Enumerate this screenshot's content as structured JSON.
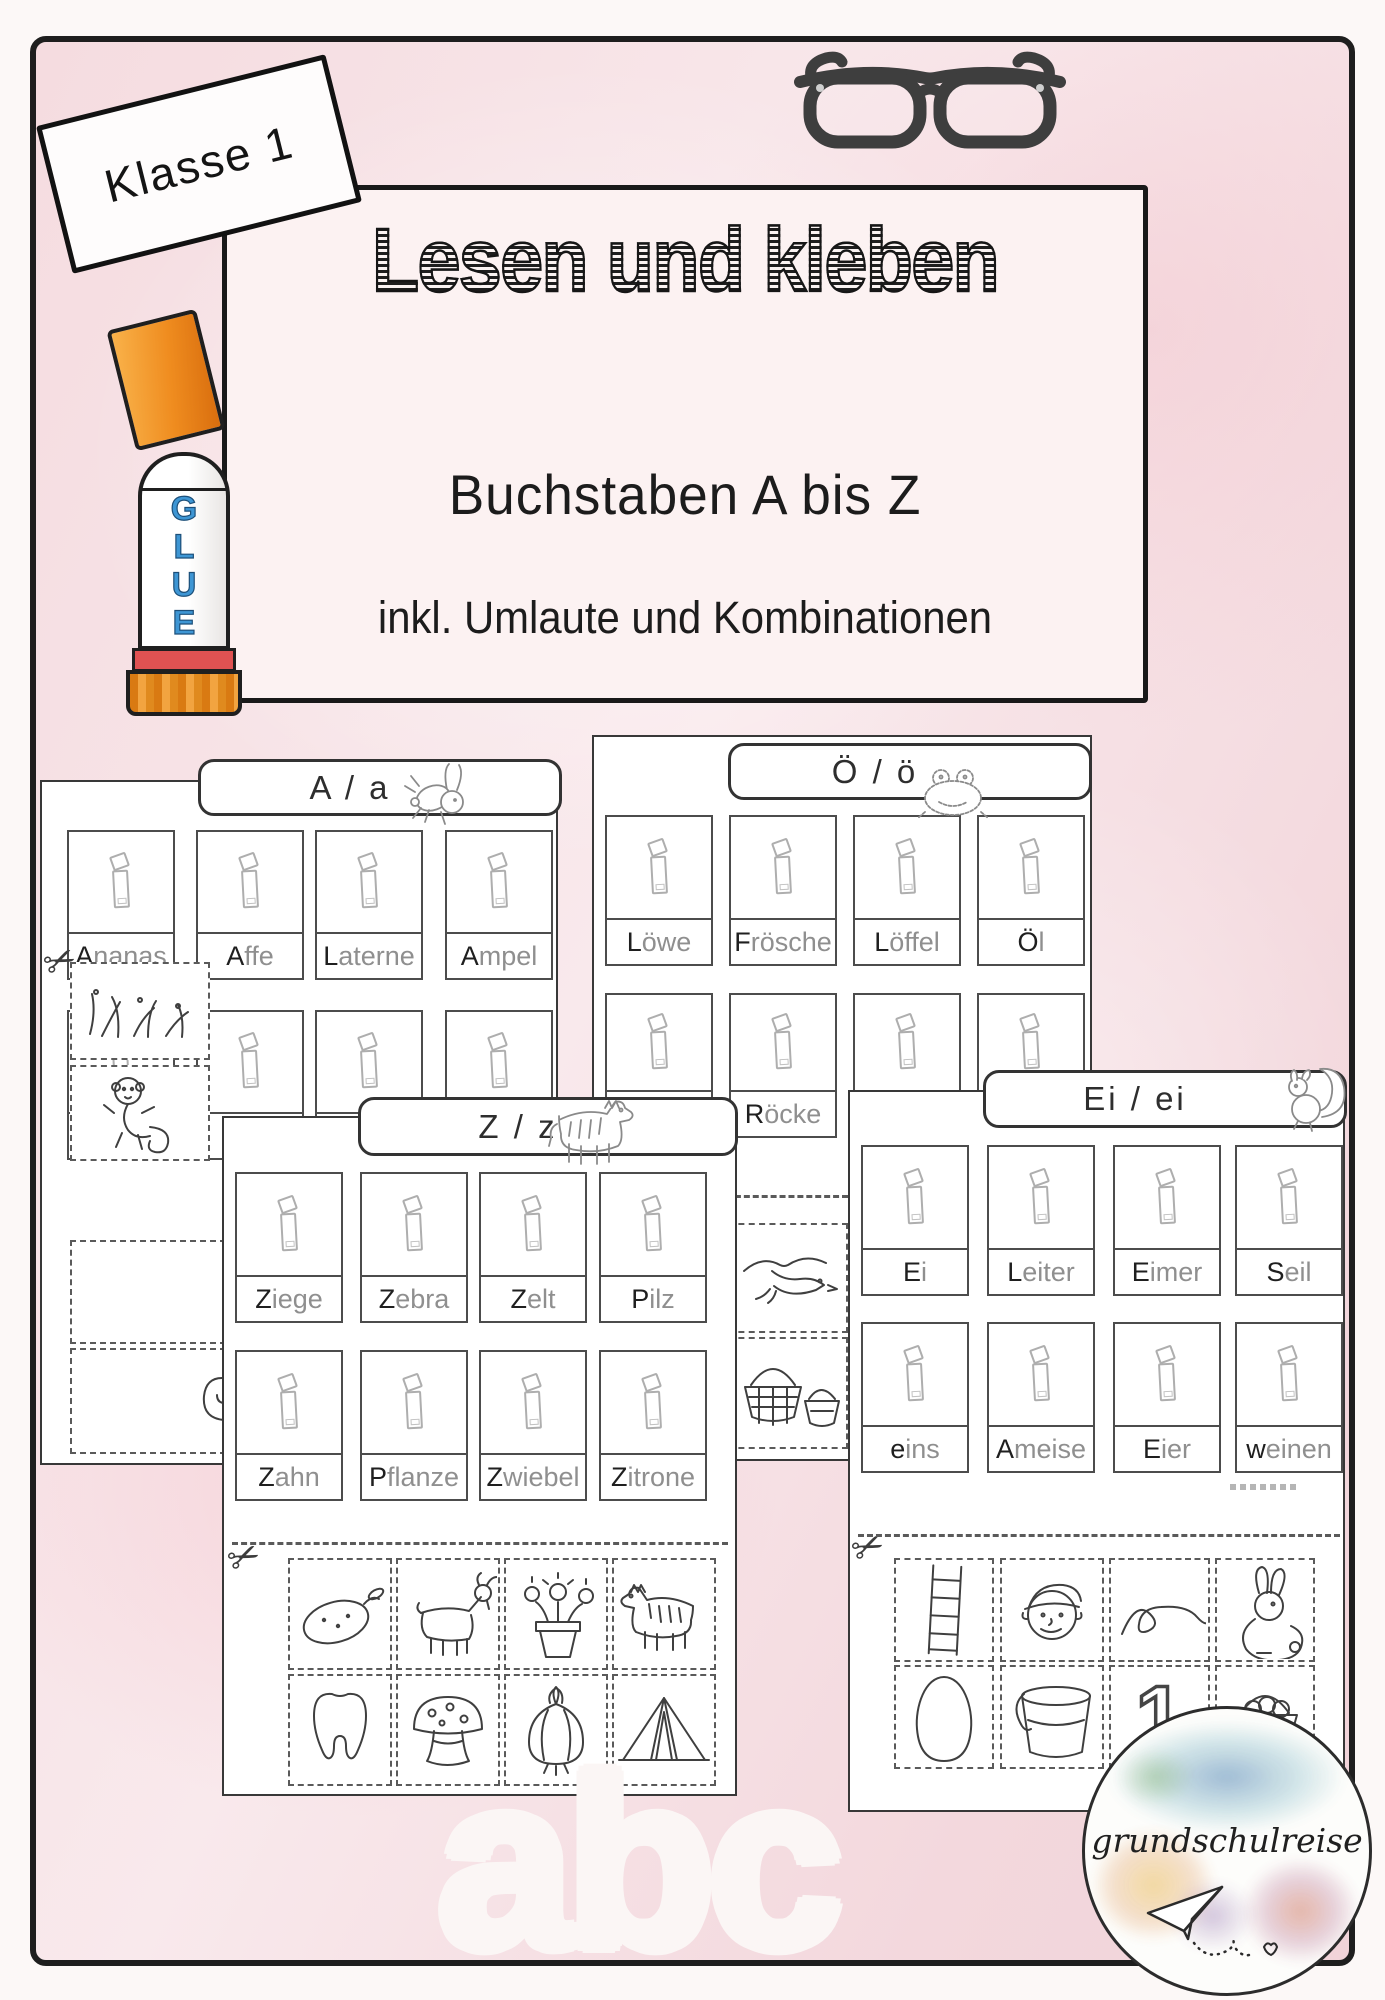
{
  "badge": {
    "label": "Klasse 1"
  },
  "title": {
    "main": "Lesen und kleben",
    "sub1": "Buchstaben A bis Z",
    "sub2": "inkl. Umlaute und Kombinationen"
  },
  "glue": {
    "letters": [
      "G",
      "L",
      "U",
      "E"
    ]
  },
  "sheets": {
    "a": {
      "header": "A / a",
      "mascot": "bunny-icon",
      "row1": [
        "Ananas",
        "Affe",
        "Laterne",
        "Ampel"
      ],
      "row2": [
        "Nadel",
        "",
        "",
        ""
      ],
      "strip_pictures": [
        "grass",
        "monkey",
        "spiral"
      ]
    },
    "o": {
      "header": "Ö / ö",
      "mascot": "frog-icon",
      "row1": [
        "Löwe",
        "Frösche",
        "Löffel",
        "Öl"
      ],
      "row2": [
        "",
        "Röcke",
        "",
        ""
      ],
      "strip_pictures": [
        "bird",
        "baskets"
      ]
    },
    "z": {
      "header": "Z / z",
      "mascot": "zebra-icon",
      "row1": [
        "Ziege",
        "Zebra",
        "Zelt",
        "Pilz"
      ],
      "row2": [
        "Zahn",
        "Pflanze",
        "Zwiebel",
        "Zitrone"
      ],
      "strip_pictures": [
        "lemon",
        "goat",
        "flower-pot",
        "zebra",
        "tooth",
        "mushroom",
        "onion",
        "tent"
      ]
    },
    "ei": {
      "header": "Ei / ei",
      "mascot": "squirrel-icon",
      "row1": [
        "Ei",
        "Leiter",
        "Eimer",
        "Seil"
      ],
      "row2": [
        "eins",
        "Ameise",
        "Eier",
        "weinen"
      ],
      "strip_pictures": [
        "ladder",
        "man",
        "rope",
        "rabbit",
        "egg",
        "bucket",
        "numeral-one",
        "egg-basket"
      ],
      "strip_numeral": "1"
    }
  },
  "big_letters": "abc",
  "logo": {
    "text": "grundschulreise"
  },
  "colors": {
    "background_pink": "#f6dee2",
    "frame_black": "#1e1e1e",
    "glue_blue": "#3e96d4",
    "cap_orange": "#ef8c1f",
    "stripe_red": "#e05252"
  }
}
